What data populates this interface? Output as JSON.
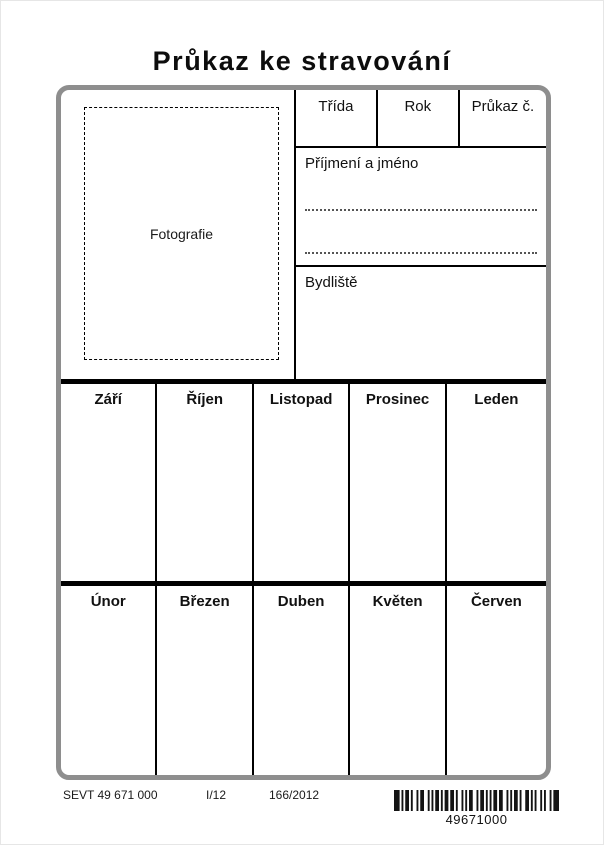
{
  "title": "Průkaz ke stravování",
  "card": {
    "photo": {
      "label": "Fotografie"
    },
    "header_fields": [
      {
        "label": "Třída"
      },
      {
        "label": "Rok"
      },
      {
        "label": "Průkaz č."
      }
    ],
    "name_section": {
      "label": "Příjmení a jméno"
    },
    "residence_section": {
      "label": "Bydliště"
    },
    "month_rows": [
      {
        "months": [
          "Září",
          "Říjen",
          "Listopad",
          "Prosinec",
          "Leden"
        ]
      },
      {
        "months": [
          "Únor",
          "Březen",
          "Duben",
          "Květen",
          "Červen"
        ]
      }
    ]
  },
  "footer": {
    "form_code": "SEVT 49 671 000",
    "edition": "I/12",
    "order_number": "166/2012",
    "barcode_number": "49671000"
  },
  "colors": {
    "card_border_gray": "#8e8e8e",
    "line_black": "#000000",
    "text_black": "#111111"
  }
}
